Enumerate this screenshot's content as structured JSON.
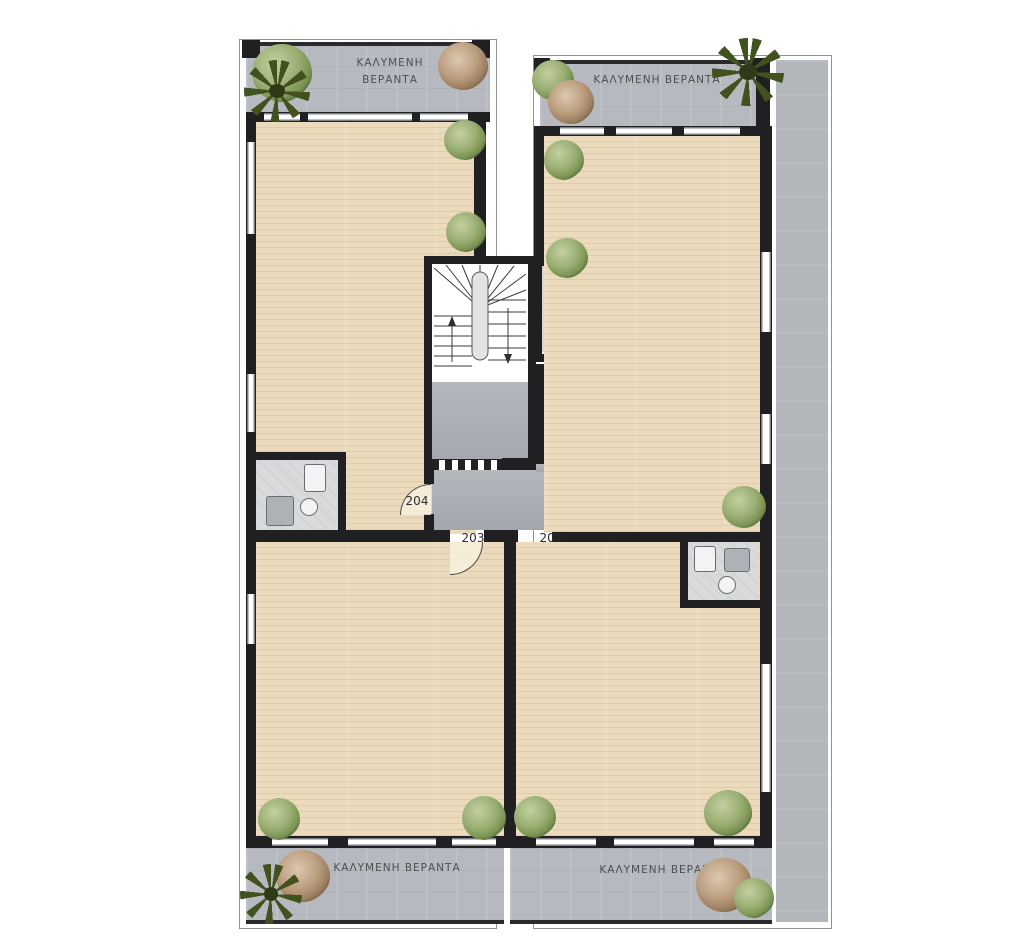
{
  "plan": {
    "title": "floor-plan-level-2",
    "verandas": [
      {
        "position": "top-left",
        "label": "ΚΑΛΥΜΕΝΗ ΒΕΡΑΝΤΑ"
      },
      {
        "position": "top-right",
        "label": "ΚΑΛΥΜΕΝΗ ΒΕΡΑΝΤΑ"
      },
      {
        "position": "bottom-left",
        "label": "ΚΑΛΥΜΕΝΗ ΒΕΡΑΝΤΑ"
      },
      {
        "position": "bottom-right",
        "label": "ΚΑΛΥΜΕΝΗ ΒΕΡΑΝΤΑ"
      }
    ],
    "units": [
      {
        "number": "204"
      },
      {
        "number": "201"
      },
      {
        "number": "203"
      },
      {
        "number": "202"
      }
    ],
    "colors": {
      "wall": "#202022",
      "veranda": "#b6bac0",
      "walkway": "#b3b7bc",
      "corridor": "#abb0b6",
      "floor": "#ebdabb",
      "bath": "#d8dadc",
      "plant_green": "#8da569",
      "plant_brown": "#b79878",
      "plant_dark": "#42521f"
    }
  }
}
